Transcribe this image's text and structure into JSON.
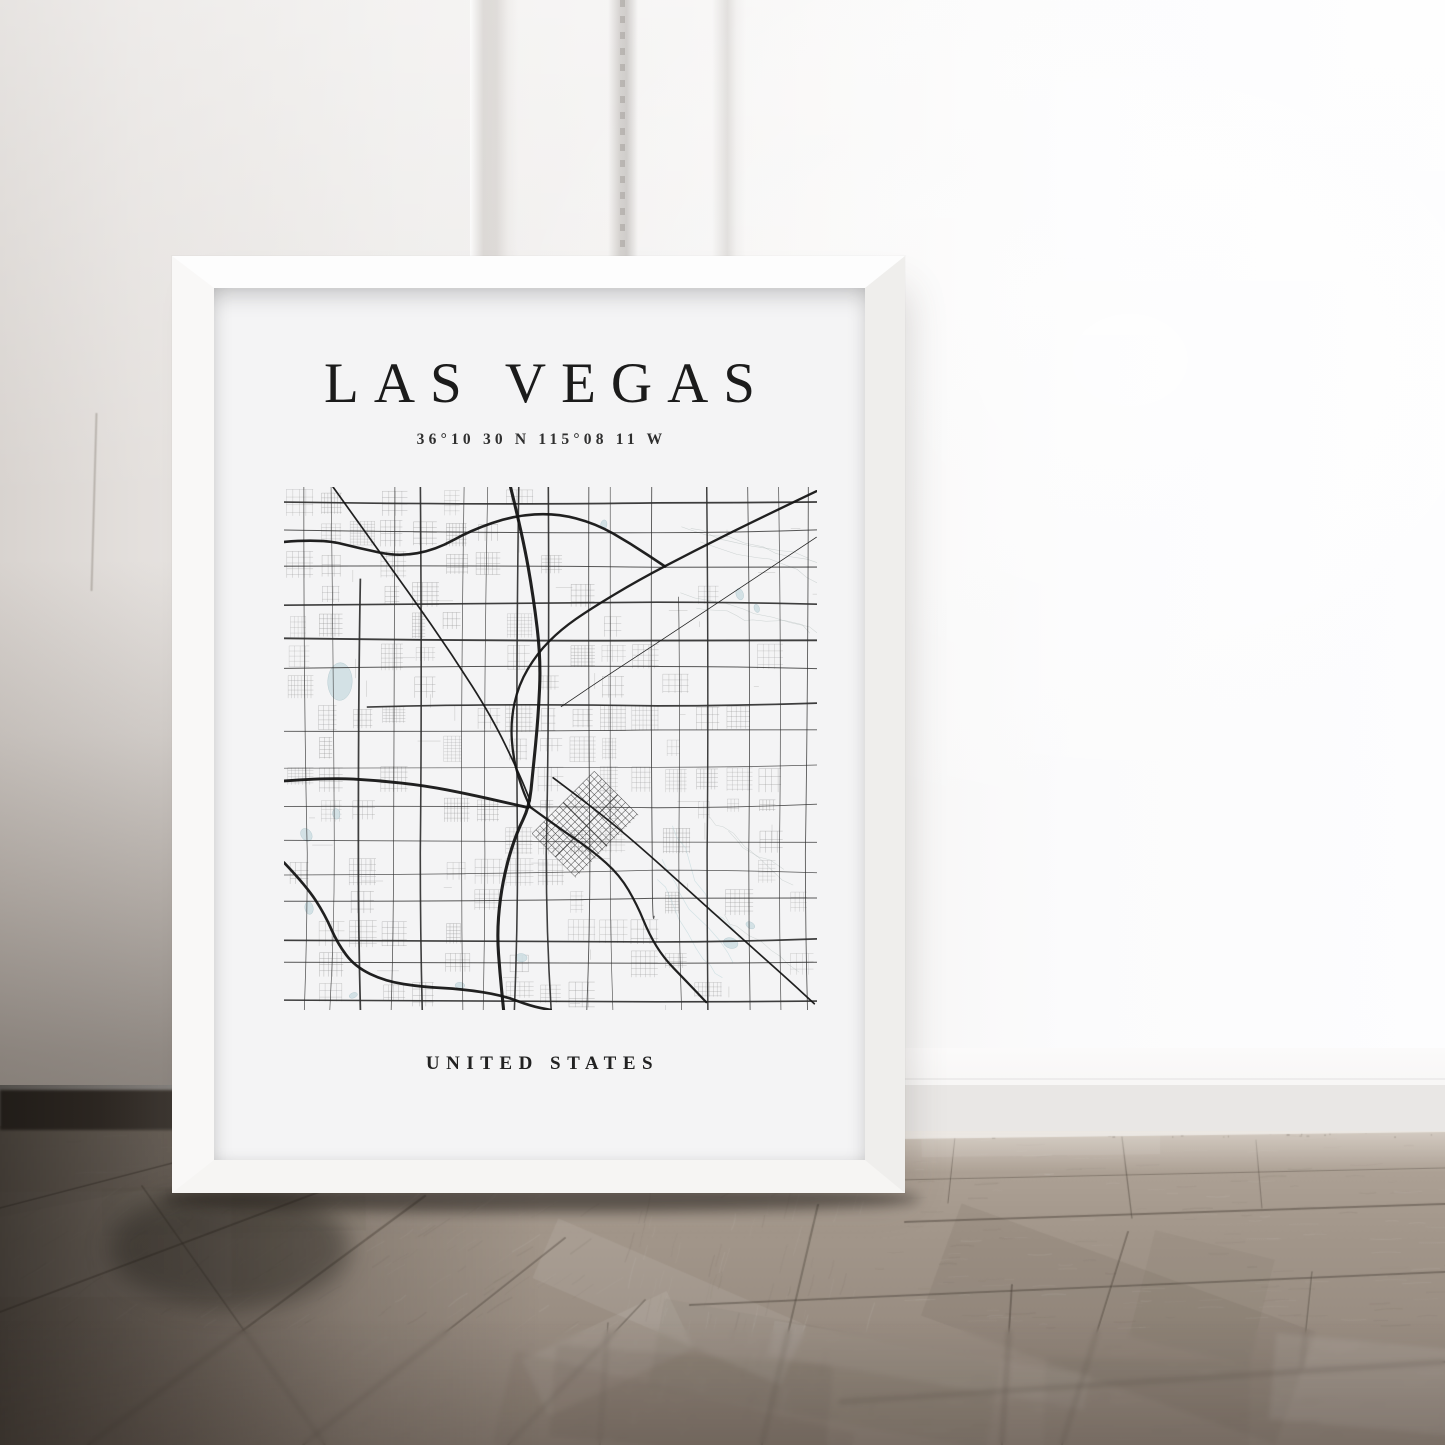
{
  "poster": {
    "title": "LAS VEGAS",
    "coordinates": "36°10 30 N 115°08 11 W",
    "country": "UNITED STATES"
  },
  "palette": {
    "wall_left": "#d8d3cf",
    "wall_right": "#fdfdfe",
    "frame_white": "#fdfdfd",
    "poster_background": "#f4f4f5",
    "title_text": "#1b1b1b",
    "floor_light": "#b2a69a",
    "floor_mid": "#9c9085",
    "floor_dark": "#82776d",
    "floor_seam": "#483f37",
    "shadow_corner": "#2f2a25"
  },
  "map_render": {
    "seed": 7,
    "width": 533,
    "height": 523,
    "arterial_color": "#2e2e2e",
    "minor_color": "#8f8f8f",
    "freeway_color": "#141414",
    "water_color": "#cfdfe3",
    "water_edge": "#8fb0b8",
    "desert_color": "#a9b6b4",
    "wash_color": "#bcd6da",
    "downtown": {
      "cx": 0.565,
      "cy": 0.645,
      "rot": -45,
      "w": 88,
      "h": 62,
      "step": 5.5
    },
    "freeways": [
      {
        "w": 2.6,
        "pts": [
          [
            0,
            0.105
          ],
          [
            0.07,
            0.099
          ],
          [
            0.145,
            0.118
          ],
          [
            0.215,
            0.133
          ],
          [
            0.285,
            0.12
          ],
          [
            0.35,
            0.083
          ],
          [
            0.43,
            0.055
          ],
          [
            0.51,
            0.05
          ],
          [
            0.585,
            0.07
          ],
          [
            0.65,
            0.108
          ],
          [
            0.715,
            0.152
          ]
        ]
      },
      {
        "w": 2.3,
        "pts": [
          [
            0.999,
            0.008
          ],
          [
            0.88,
            0.066
          ],
          [
            0.77,
            0.122
          ],
          [
            0.665,
            0.178
          ],
          [
            0.575,
            0.233
          ],
          [
            0.52,
            0.272
          ],
          [
            0.475,
            0.318
          ],
          [
            0.44,
            0.378
          ],
          [
            0.425,
            0.448
          ],
          [
            0.43,
            0.52
          ],
          [
            0.447,
            0.578
          ],
          [
            0.462,
            0.612
          ]
        ]
      },
      {
        "w": 1.7,
        "pts": [
          [
            0.092,
            0
          ],
          [
            0.155,
            0.09
          ],
          [
            0.235,
            0.203
          ],
          [
            0.315,
            0.32
          ],
          [
            0.39,
            0.44
          ],
          [
            0.44,
            0.545
          ],
          [
            0.462,
            0.6
          ]
        ]
      },
      {
        "w": 3.1,
        "pts": [
          [
            0.425,
            0
          ],
          [
            0.448,
            0.095
          ],
          [
            0.468,
            0.21
          ],
          [
            0.482,
            0.33
          ],
          [
            0.477,
            0.44
          ],
          [
            0.467,
            0.545
          ],
          [
            0.46,
            0.612
          ],
          [
            0.437,
            0.66
          ],
          [
            0.418,
            0.72
          ],
          [
            0.405,
            0.788
          ],
          [
            0.4,
            0.858
          ],
          [
            0.405,
            0.928
          ],
          [
            0.412,
            1.0
          ]
        ]
      },
      {
        "w": 2.9,
        "pts": [
          [
            0,
            0.562
          ],
          [
            0.085,
            0.556
          ],
          [
            0.175,
            0.561
          ],
          [
            0.265,
            0.571
          ],
          [
            0.345,
            0.587
          ],
          [
            0.415,
            0.603
          ],
          [
            0.458,
            0.613
          ]
        ]
      },
      {
        "w": 1.7,
        "pts": [
          [
            0.505,
            0.556
          ],
          [
            0.585,
            0.617
          ],
          [
            0.665,
            0.685
          ],
          [
            0.75,
            0.763
          ],
          [
            0.848,
            0.853
          ],
          [
            0.946,
            0.942
          ],
          [
            0.995,
            0.988
          ]
        ]
      },
      {
        "w": 2.7,
        "pts": [
          [
            0,
            0.718
          ],
          [
            0.042,
            0.763
          ],
          [
            0.077,
            0.818
          ],
          [
            0.1,
            0.872
          ],
          [
            0.133,
            0.917
          ],
          [
            0.19,
            0.945
          ],
          [
            0.26,
            0.956
          ],
          [
            0.335,
            0.96
          ],
          [
            0.41,
            0.972
          ],
          [
            0.462,
            0.992
          ],
          [
            0.5,
            1.0
          ]
        ]
      },
      {
        "w": 2.2,
        "pts": [
          [
            0.462,
            0.612
          ],
          [
            0.52,
            0.655
          ],
          [
            0.578,
            0.695
          ],
          [
            0.63,
            0.742
          ],
          [
            0.663,
            0.8
          ],
          [
            0.685,
            0.855
          ],
          [
            0.712,
            0.9
          ],
          [
            0.752,
            0.942
          ],
          [
            0.792,
            0.985
          ]
        ]
      },
      {
        "w": 0.8,
        "pts": [
          [
            0.999,
            0.096
          ],
          [
            0.86,
            0.19
          ],
          [
            0.72,
            0.285
          ],
          [
            0.6,
            0.365
          ],
          [
            0.52,
            0.42
          ]
        ]
      }
    ],
    "water": [
      [
        0.105,
        0.372,
        0.023,
        0.036
      ],
      [
        0.042,
        0.665,
        0.013,
        0.01
      ],
      [
        0.098,
        0.625,
        0.01,
        0.007
      ],
      [
        0.047,
        0.805,
        0.012,
        0.008
      ],
      [
        0.855,
        0.205,
        0.011,
        0.007
      ],
      [
        0.887,
        0.232,
        0.008,
        0.005
      ],
      [
        0.6,
        0.072,
        0.009,
        0.006
      ],
      [
        0.445,
        0.9,
        0.011,
        0.008
      ],
      [
        0.33,
        0.953,
        0.009,
        0.006
      ],
      [
        0.838,
        0.872,
        0.014,
        0.01
      ],
      [
        0.875,
        0.838,
        0.009,
        0.006
      ],
      [
        0.13,
        0.972,
        0.008,
        0.005
      ]
    ]
  },
  "floor_render": {
    "seed": 3,
    "boundary": [
      [
        0,
        41
      ],
      [
        180,
        44
      ],
      [
        900,
        54
      ],
      [
        1445,
        47
      ]
    ],
    "seams": [
      [
        0,
        227,
        335,
        101,
        2.0
      ],
      [
        88,
        360,
        425,
        111,
        2.2
      ],
      [
        303,
        360,
        565,
        153,
        2.0
      ],
      [
        508,
        360,
        645,
        215,
        1.8
      ],
      [
        0,
        123,
        192,
        73,
        1.5
      ],
      [
        142,
        101,
        325,
        360,
        1.6
      ],
      [
        905,
        137,
        1445,
        119,
        2.0
      ],
      [
        690,
        220,
        1445,
        187,
        2.2
      ],
      [
        840,
        317,
        1445,
        277,
        2.4
      ],
      [
        1122,
        52,
        1132,
        133,
        1.4
      ],
      [
        1256,
        55,
        1262,
        123,
        1.2
      ],
      [
        1012,
        200,
        1002,
        360,
        2.0
      ],
      [
        1312,
        187,
        1302,
        283,
        1.6
      ],
      [
        818,
        120,
        762,
        360,
        2.2
      ],
      [
        1128,
        147,
        1062,
        360,
        2.0
      ],
      [
        899,
        95,
        1445,
        83,
        1.2
      ],
      [
        955,
        52,
        948,
        118,
        1.0
      ],
      [
        608,
        238,
        600,
        360,
        1.4
      ]
    ]
  }
}
